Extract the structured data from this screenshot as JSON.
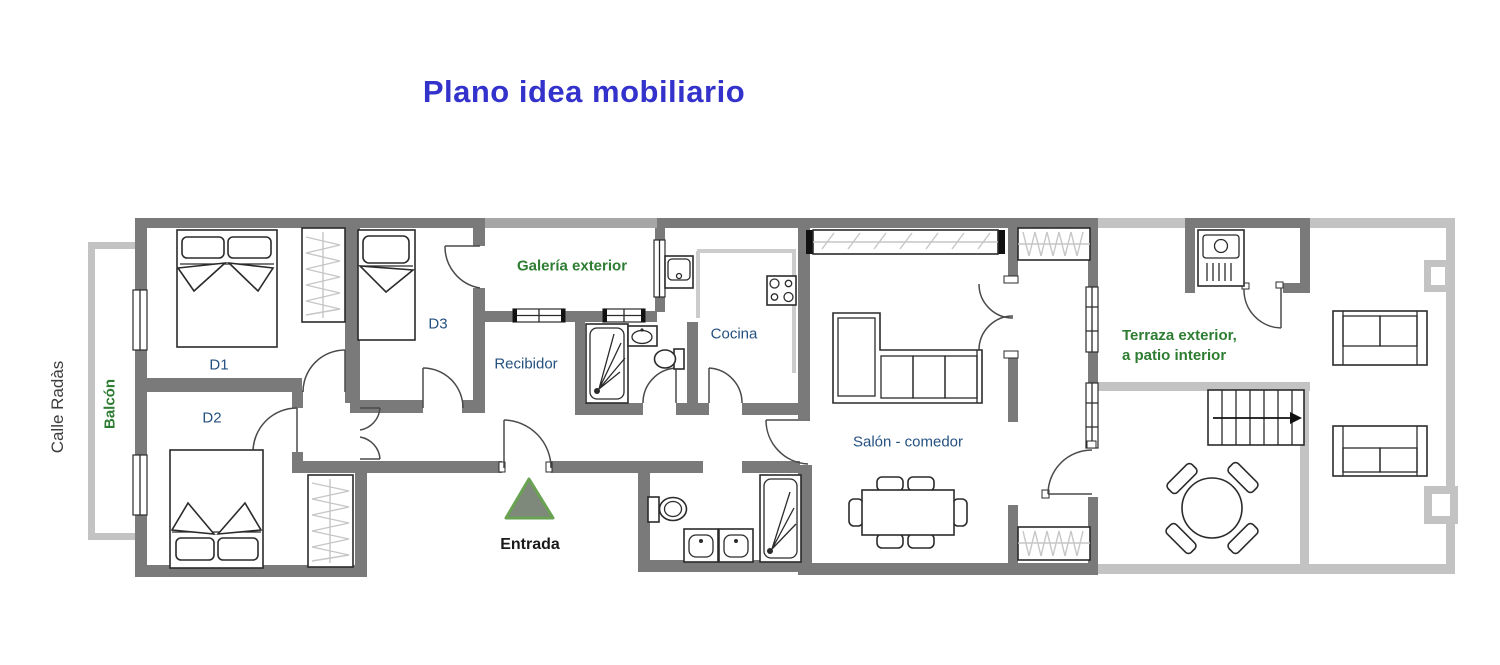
{
  "title": "Plano idea mobiliario",
  "street_label": "Calle Radàs",
  "rooms": {
    "balcony": "Balcón",
    "bedroom1": "D1",
    "bedroom2": "D2",
    "bedroom3": "D3",
    "gallery": "Galería exterior",
    "hallway": "Recibidor",
    "kitchen": "Cocina",
    "living_dining": "Salón - comedor",
    "terrace_line1": "Terraza exterior,",
    "terrace_line2": "a patio interior",
    "entrance": "Entrada"
  },
  "colors": {
    "title_blue": "#3333cc",
    "label_navy": "#255180",
    "label_green": "#2e7d32",
    "label_black": "#1a1a1a",
    "wall_dark": "#7a7a7a",
    "wall_medium": "#a6a6a6",
    "wall_light": "#c3c3c3",
    "marker_fill": "#7e887b",
    "marker_border": "#6aa254"
  }
}
